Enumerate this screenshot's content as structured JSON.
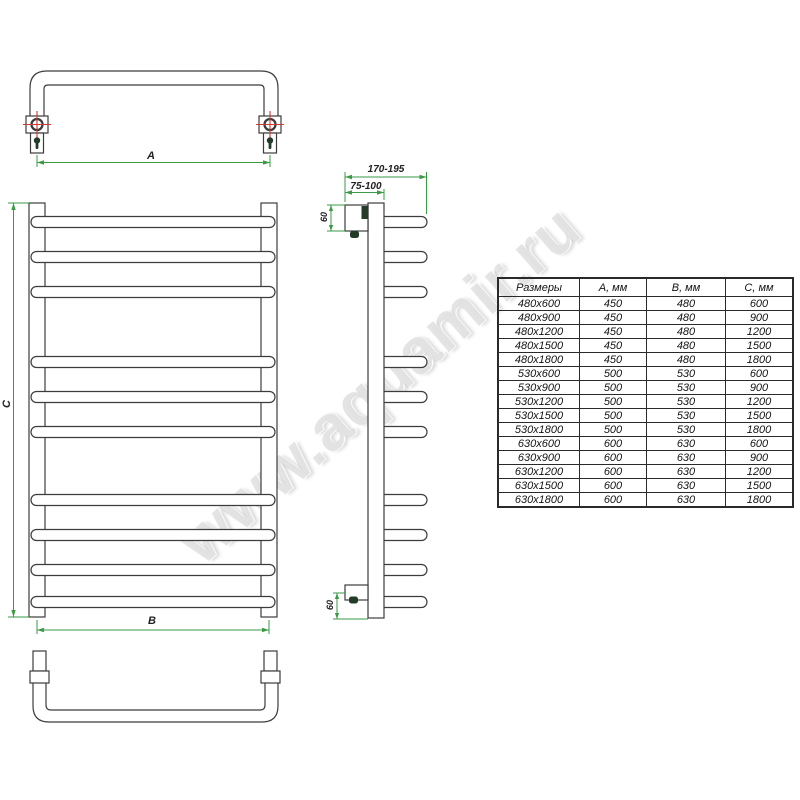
{
  "watermark": {
    "text": "www.aquamir.ru"
  },
  "dimensions": {
    "a_label": "A",
    "b_label": "B",
    "c_label": "C",
    "depth_range": "170-195",
    "wall_distance_range": "75-100",
    "top_offset": "60",
    "bottom_offset": "60"
  },
  "table": {
    "headers": [
      "Размеры",
      "А, мм",
      "В, мм",
      "С, мм"
    ],
    "rows": [
      [
        "480x600",
        "450",
        "480",
        "600"
      ],
      [
        "480x900",
        "450",
        "480",
        "900"
      ],
      [
        "480x1200",
        "450",
        "480",
        "1200"
      ],
      [
        "480x1500",
        "450",
        "480",
        "1500"
      ],
      [
        "480x1800",
        "450",
        "480",
        "1800"
      ],
      [
        "530x600",
        "500",
        "530",
        "600"
      ],
      [
        "530x900",
        "500",
        "530",
        "900"
      ],
      [
        "530x1200",
        "500",
        "530",
        "1200"
      ],
      [
        "530x1500",
        "500",
        "530",
        "1500"
      ],
      [
        "530x1800",
        "500",
        "530",
        "1800"
      ],
      [
        "630x600",
        "600",
        "630",
        "600"
      ],
      [
        "630x900",
        "600",
        "630",
        "900"
      ],
      [
        "630x1200",
        "600",
        "630",
        "1200"
      ],
      [
        "630x1500",
        "600",
        "630",
        "1500"
      ],
      [
        "630x1800",
        "600",
        "630",
        "1800"
      ]
    ]
  },
  "colors": {
    "line": "#3c3c3c",
    "dimension_green": "#3a9a45",
    "crosshair_red": "#cd3a31",
    "keyhole_dark": "#233c2a"
  }
}
